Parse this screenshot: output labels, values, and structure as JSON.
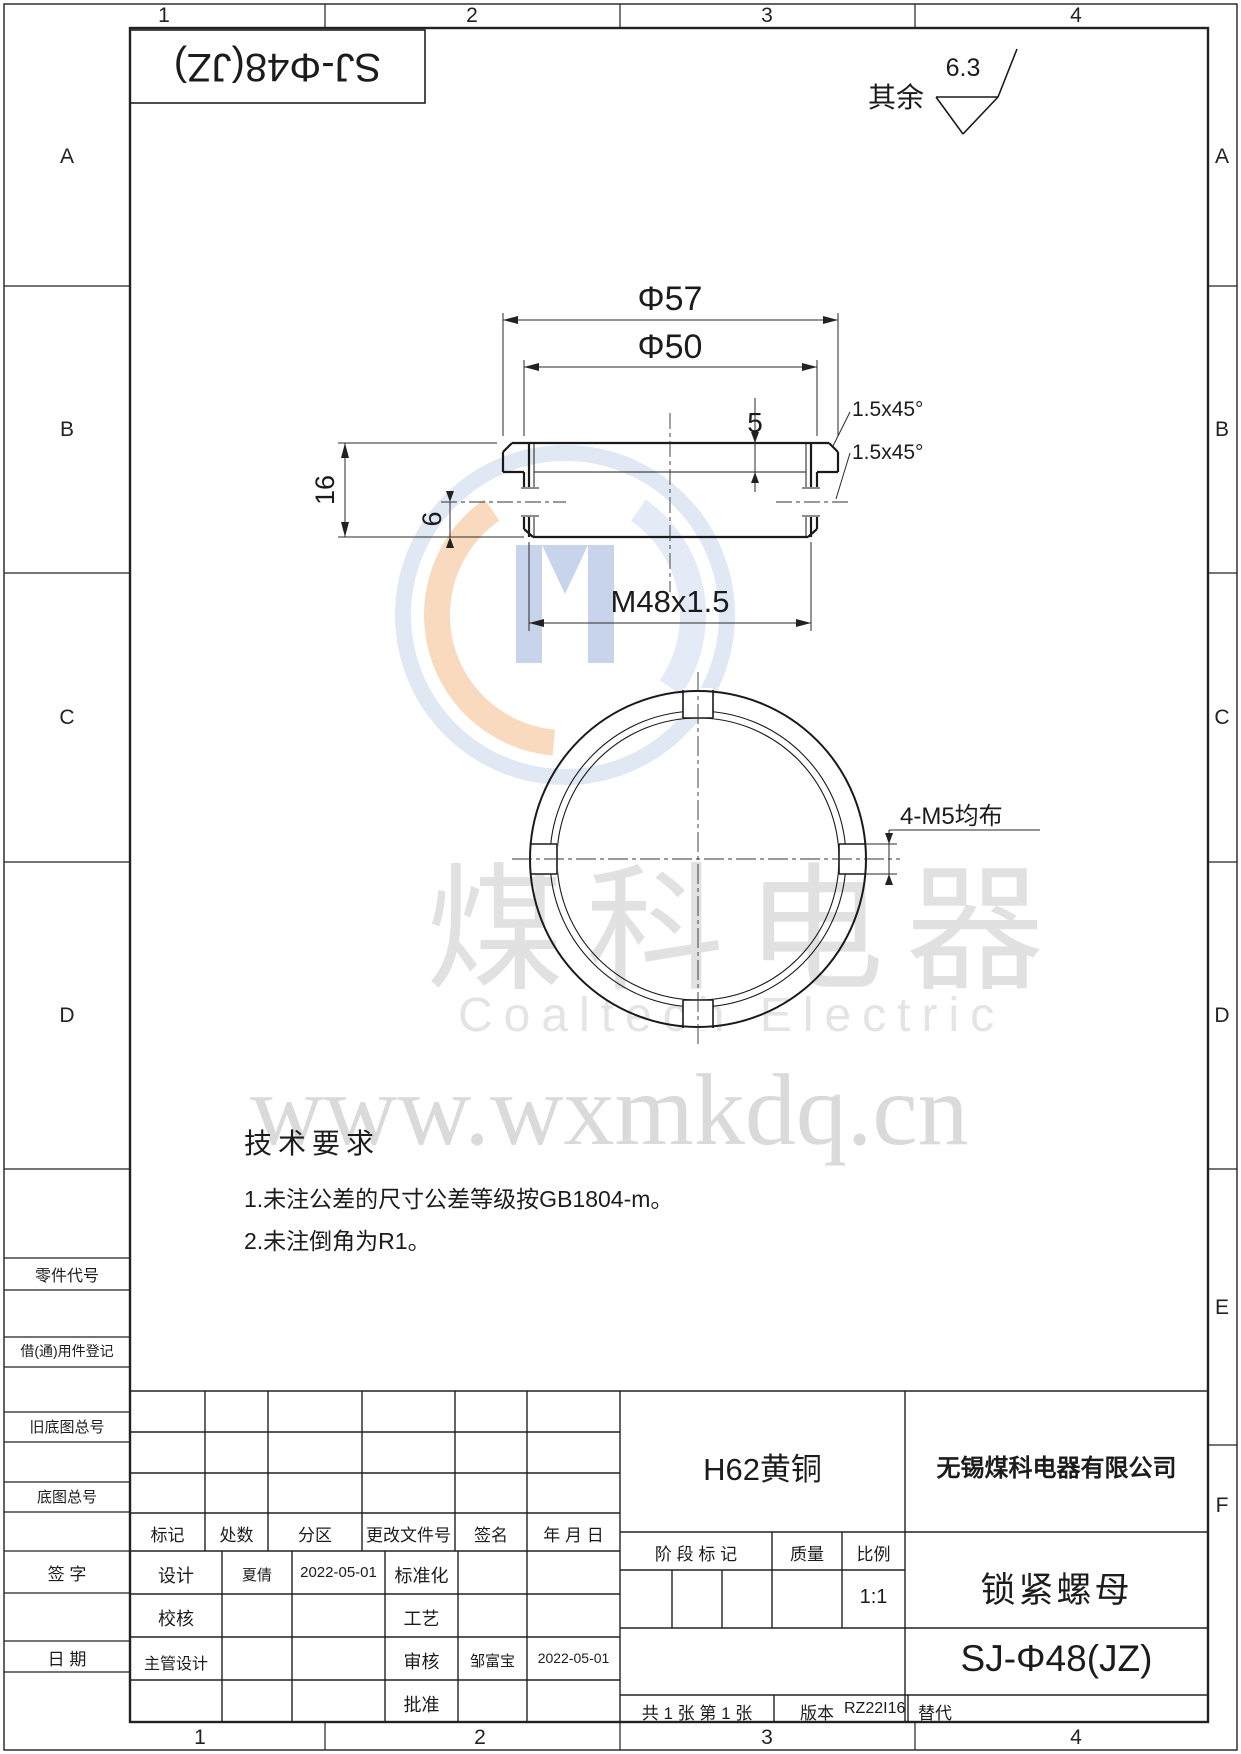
{
  "zones": {
    "cols": [
      "1",
      "2",
      "3",
      "4"
    ],
    "left_rows": [
      "A",
      "B",
      "C",
      "D"
    ],
    "right_rows": [
      "A",
      "B",
      "C",
      "D",
      "E",
      "F"
    ]
  },
  "header": {
    "flipped_title": "SJ-Φ48(JZ)",
    "roughness_prefix": "其余",
    "roughness_value": "6.3"
  },
  "section_view": {
    "dia_outer": "Φ57",
    "dia_body": "Φ50",
    "flange_thk": "5",
    "height": "16",
    "hole_offset": "6",
    "thread": "M48x1.5",
    "chamfer1": "1.5x45°",
    "chamfer2": "1.5x45°"
  },
  "front_view": {
    "holes_label": "4-M5均布"
  },
  "watermark": {
    "cn": "煤科电器",
    "en": "Coaltech Electric",
    "url": "www.wxmkdq.cn"
  },
  "tech_req": {
    "title": "技术要求",
    "item1": "1.未注公差的尺寸公差等级按GB1804-m。",
    "item2": "2.未注倒角为R1。"
  },
  "margin_labels": [
    "零件代号",
    "借(通)用件登记",
    "旧底图总号",
    "底图总号",
    "签 字",
    "日 期"
  ],
  "title_block": {
    "rev_headers": [
      "标记",
      "处数",
      "分区",
      "更改文件号",
      "签名",
      "年 月 日"
    ],
    "sign_rows": [
      {
        "l": "设计",
        "n": "夏倩",
        "d": "2022-05-01",
        "l2": "标准化",
        "n2": "",
        "d2": ""
      },
      {
        "l": "校核",
        "n": "",
        "d": "",
        "l2": "工艺",
        "n2": "",
        "d2": ""
      },
      {
        "l": "主管设计",
        "n": "",
        "d": "",
        "l2": "审核",
        "n2": "邹富宝",
        "d2": "2022-05-01"
      },
      {
        "l": "",
        "n": "",
        "d": "",
        "l2": "批准",
        "n2": "",
        "d2": ""
      }
    ],
    "material": "H62黄铜",
    "company": "无锡煤科电器有限公司",
    "stage_header": [
      "阶 段 标 记",
      "质量",
      "比例"
    ],
    "scale_value": "1:1",
    "part_name": "锁紧螺母",
    "drawing_no": "SJ-Φ48(JZ)",
    "sheet_info": "共 1 张  第 1 张",
    "version_label": "版本",
    "version_value": "RZ22I16",
    "replace_label": "替代"
  }
}
